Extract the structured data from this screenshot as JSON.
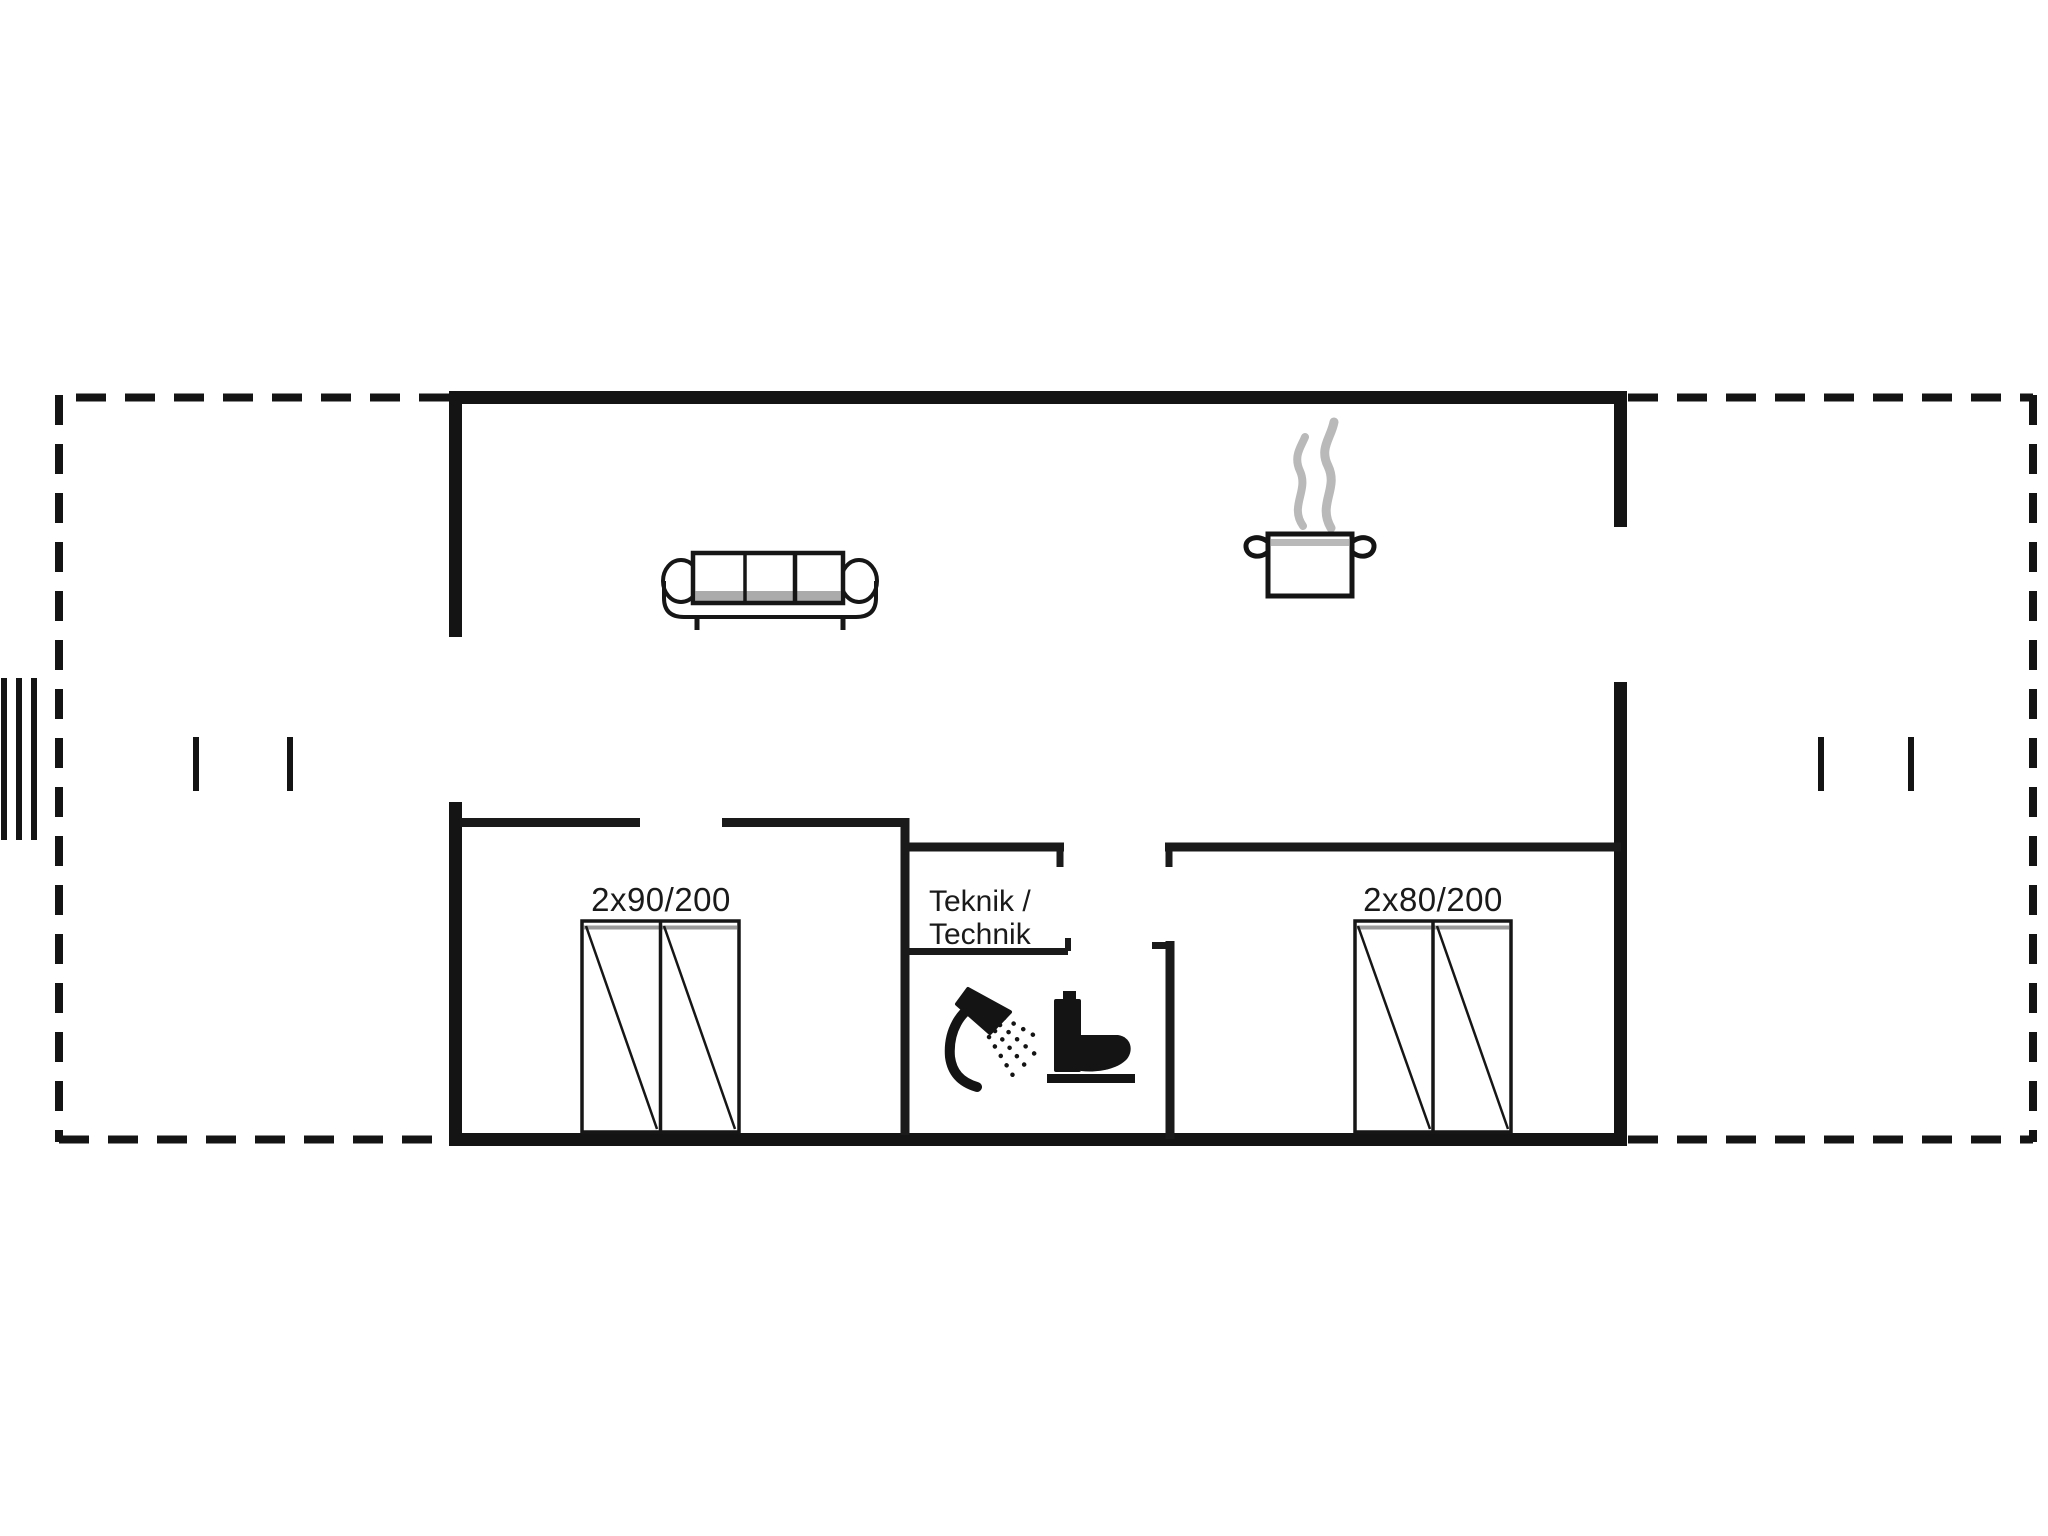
{
  "plan": {
    "type": "floor-plan",
    "rooms": {
      "bedroom_left": {
        "bed_size_label": "2x90/200"
      },
      "bedroom_right": {
        "bed_size_label": "2x80/200"
      },
      "utility_room": {
        "label_line1": "Teknik /",
        "label_line2": "Technik"
      }
    },
    "icons": {
      "sofa": "sofa-icon",
      "cooking_pot": "cooking-pot-icon",
      "steam": "steam-icon",
      "shower": "shower-icon",
      "toilet": "toilet-icon",
      "wardrobe_left": "wardrobe-icon",
      "wardrobe_right": "wardrobe-icon",
      "terrace_left": "dashed-terrace-outline",
      "terrace_right": "dashed-terrace-outline",
      "steps_left": "steps-marker-icon"
    },
    "colors": {
      "wall": "#141414",
      "text": "#1a1a1a",
      "shading_gray": "#9a9a9a",
      "steam_gray": "#b9b9b9",
      "background": "#ffffff"
    }
  }
}
